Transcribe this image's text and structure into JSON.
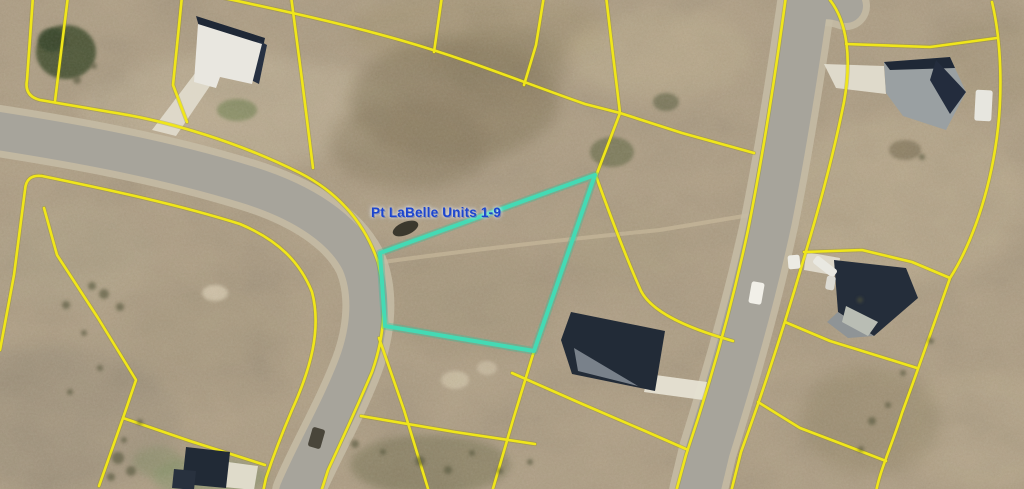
{
  "map": {
    "label": {
      "text": "Pt LaBelle Units 1-9",
      "x": 371,
      "y": 205,
      "font_size": 13.5,
      "color": "#1c45cf"
    },
    "canvas": {
      "width": 1024,
      "height": 489
    },
    "colors": {
      "terrain_base": "#b2a288",
      "road_pavement": "#a7a49b",
      "road_shoulder": "#c6bca6",
      "parcel_line_yellow": "#f0e61a",
      "parcel_line_under": "#8e8700",
      "highlight_cyan": "#44dab4",
      "highlight_glow": "#2fbf9a",
      "roof_navy": "#232c38",
      "roof_gray": "#9aa0a2",
      "driveway_white": "#e6e1d3",
      "track_pale": "#cbbd9e"
    },
    "terrain_patches": [
      {
        "cx": 240,
        "cy": 110,
        "rx": 160,
        "ry": 55,
        "fill": "#cbbda1",
        "op": 0.45,
        "f": "b8"
      },
      {
        "cx": 480,
        "cy": 30,
        "rx": 130,
        "ry": 40,
        "fill": "#a4946f",
        "op": 0.4,
        "f": "b8"
      },
      {
        "cx": 455,
        "cy": 100,
        "rx": 105,
        "ry": 62,
        "fill": "#837659",
        "op": 0.5,
        "f": "b8"
      },
      {
        "cx": 410,
        "cy": 145,
        "rx": 80,
        "ry": 45,
        "fill": "#8a7c5e",
        "op": 0.45,
        "f": "b8"
      },
      {
        "cx": 505,
        "cy": 65,
        "rx": 60,
        "ry": 40,
        "fill": "#8f8163",
        "op": 0.4,
        "f": "b8"
      },
      {
        "cx": 660,
        "cy": 55,
        "rx": 90,
        "ry": 45,
        "fill": "#c6b795",
        "op": 0.4,
        "f": "b8"
      },
      {
        "cx": 905,
        "cy": 200,
        "rx": 120,
        "ry": 85,
        "fill": "#c3b394",
        "op": 0.45,
        "f": "b8"
      },
      {
        "cx": 990,
        "cy": 60,
        "rx": 60,
        "ry": 45,
        "fill": "#ab9c7c",
        "op": 0.4,
        "f": "b8"
      },
      {
        "cx": 70,
        "cy": 255,
        "rx": 85,
        "ry": 55,
        "fill": "#b4a78c",
        "op": 0.4,
        "f": "b8"
      },
      {
        "cx": 60,
        "cy": 420,
        "rx": 120,
        "ry": 75,
        "fill": "#9c917b",
        "op": 0.45,
        "f": "b8"
      },
      {
        "cx": 210,
        "cy": 330,
        "rx": 90,
        "ry": 60,
        "fill": "#ab9d82",
        "op": 0.35,
        "f": "b8"
      },
      {
        "cx": 470,
        "cy": 300,
        "rx": 90,
        "ry": 55,
        "fill": "#a09274",
        "op": 0.3,
        "f": "b8"
      },
      {
        "cx": 620,
        "cy": 250,
        "rx": 70,
        "ry": 45,
        "fill": "#ad9f81",
        "op": 0.3,
        "f": "b8"
      },
      {
        "cx": 980,
        "cy": 430,
        "rx": 80,
        "ry": 60,
        "fill": "#c0b092",
        "op": 0.4,
        "f": "b8"
      },
      {
        "cx": 870,
        "cy": 420,
        "rx": 70,
        "ry": 55,
        "fill": "#948768",
        "op": 0.45,
        "f": "b8"
      },
      {
        "cx": 430,
        "cy": 465,
        "rx": 80,
        "ry": 30,
        "fill": "#6f6e4e",
        "op": 0.45,
        "f": "b4"
      },
      {
        "cx": 368,
        "cy": 295,
        "rx": 18,
        "ry": 50,
        "fill": "#cfc2a7",
        "op": 0.55,
        "f": "b4"
      },
      {
        "cx": 215,
        "cy": 293,
        "rx": 13,
        "ry": 8,
        "fill": "#dccfb4",
        "op": 0.8,
        "f": "b2"
      },
      {
        "cx": 455,
        "cy": 380,
        "rx": 14,
        "ry": 9,
        "fill": "#d3c6aa",
        "op": 0.75,
        "f": "b2"
      },
      {
        "cx": 487,
        "cy": 368,
        "rx": 10,
        "ry": 7,
        "fill": "#d0c3a8",
        "op": 0.7,
        "f": "b2"
      },
      {
        "cx": 66,
        "cy": 52,
        "rx": 30,
        "ry": 27,
        "fill": "#42502f",
        "op": 0.85,
        "f": "b2"
      },
      {
        "cx": 52,
        "cy": 40,
        "rx": 14,
        "ry": 12,
        "fill": "#39462a",
        "op": 0.8,
        "f": "b2"
      },
      {
        "cx": 237,
        "cy": 110,
        "rx": 20,
        "ry": 11,
        "fill": "#7e8a5c",
        "op": 0.7,
        "f": "b2"
      },
      {
        "cx": 612,
        "cy": 152,
        "rx": 22,
        "ry": 15,
        "fill": "#5d6540",
        "op": 0.55,
        "f": "b2"
      },
      {
        "cx": 666,
        "cy": 102,
        "rx": 13,
        "ry": 9,
        "fill": "#4f5637",
        "op": 0.5,
        "f": "b2"
      },
      {
        "cx": 905,
        "cy": 150,
        "rx": 16,
        "ry": 10,
        "fill": "#6c6247",
        "op": 0.5,
        "f": "b2"
      },
      {
        "cx": 210,
        "cy": 477,
        "rx": 58,
        "ry": 20,
        "fill": "#8c9a6f",
        "op": 0.55,
        "f": "b4"
      },
      {
        "cx": 158,
        "cy": 462,
        "rx": 25,
        "ry": 15,
        "fill": "#7f8f63",
        "op": 0.4,
        "f": "b4"
      }
    ],
    "shrub_dots": {
      "fill": "#55573c",
      "op": 0.6,
      "pts": [
        [
          66,
          305,
          4
        ],
        [
          84,
          333,
          3
        ],
        [
          104,
          294,
          5
        ],
        [
          92,
          286,
          4
        ],
        [
          120,
          307,
          4
        ],
        [
          100,
          368,
          3
        ],
        [
          70,
          392,
          3
        ],
        [
          140,
          422,
          3
        ],
        [
          118,
          458,
          6
        ],
        [
          131,
          471,
          5
        ],
        [
          111,
          477,
          4
        ],
        [
          124,
          440,
          3
        ],
        [
          355,
          444,
          4
        ],
        [
          383,
          452,
          3
        ],
        [
          420,
          461,
          5
        ],
        [
          448,
          470,
          4
        ],
        [
          472,
          453,
          3
        ],
        [
          500,
          471,
          3
        ],
        [
          530,
          462,
          3
        ],
        [
          872,
          421,
          4
        ],
        [
          888,
          405,
          3
        ],
        [
          903,
          373,
          3
        ],
        [
          861,
          449,
          3
        ],
        [
          931,
          341,
          3
        ],
        [
          922,
          157,
          3
        ],
        [
          860,
          300,
          3
        ],
        [
          77,
          80,
          4
        ],
        [
          94,
          66,
          3
        ]
      ]
    },
    "dirt_track": {
      "d": "M 383,262 C 470,250 580,238 660,230 L 756,214",
      "width": 4,
      "op": 0.6
    },
    "roads": [
      {
        "name": "west-road",
        "d": "M -8,130 C 70,142 160,158 245,184 C 305,202 344,230 360,262 C 373,292 370,330 357,365 C 340,410 315,452 298,492",
        "width": 38
      },
      {
        "name": "east-road",
        "d": "M 808,-10 C 798,60 786,140 770,220 C 753,300 730,380 708,450 L 698,492",
        "width": 44
      },
      {
        "name": "east-road-top-bend",
        "d": "M 806,6 C 818,2 830,0 846,6",
        "width": 34
      }
    ],
    "parcel_lines": [
      {
        "d": "M 33,-4 L 27,80 Q 24,96 40,100 L 110,112 C 170,121 240,143 300,173 C 345,196 367,230 378,262 C 387,300 385,335 372,372 C 360,400 342,440 328,470 L 321,492"
      },
      {
        "d": "M 68,-4 L 55,101"
      },
      {
        "d": "M 182,-4 L 173,85 L 187,122"
      },
      {
        "d": "M 291,-4 L 302,80 L 313,168"
      },
      {
        "d": "M 205,-6 C 260,6 330,20 400,40 C 470,60 530,85 585,104 L 620,113 L 682,133 L 754,153"
      },
      {
        "d": "M 606,-4 L 613,55 L 620,113"
      },
      {
        "d": "M 442,-4 L 434,52"
      },
      {
        "d": "M 544,-4 L 536,45 L 524,85"
      },
      {
        "d": "M 620,113 L 596,176 C 610,215 625,255 641,291 C 655,318 708,334 733,341"
      },
      {
        "d": "M 42,176 C 110,190 180,205 240,224 C 278,240 300,262 312,292 C 322,330 310,370 292,410 C 280,438 272,460 266,478 L 263,492"
      },
      {
        "d": "M 42,176 Q 26,174 25,190 L 14,275 L 0,350"
      },
      {
        "d": "M 44,208 L 57,255 L 98,318 L 136,380 L 123,418 L 99,486"
      },
      {
        "d": "M 123,418 L 190,441 L 265,465"
      },
      {
        "d": "M 379,338 L 404,410 L 429,492"
      },
      {
        "d": "M 534,351 L 513,420 L 492,492"
      },
      {
        "d": "M 512,373 L 580,403 L 645,431 L 686,449"
      },
      {
        "d": "M 361,416 L 455,432 L 535,444"
      },
      {
        "d": "M 830,0 C 847,22 852,58 844,102 C 834,152 820,205 804,258 C 786,320 763,392 741,452 L 731,492"
      },
      {
        "d": "M 786,-4 C 776,70 764,150 748,230 C 731,310 708,390 686,455 L 676,492"
      },
      {
        "d": "M 846,44 L 930,47 L 997,38"
      },
      {
        "d": "M 992,2 C 1001,40 1004,95 995,150 C 986,205 968,250 950,278 C 932,330 917,372 902,413 C 892,445 880,470 876,492"
      },
      {
        "d": "M 804,252 L 862,250 L 912,262 L 950,278"
      },
      {
        "d": "M 785,322 L 830,341 L 872,354 L 917,368"
      },
      {
        "d": "M 758,402 L 800,428 L 842,444 L 886,461"
      }
    ],
    "highlight_parcel": {
      "points": "595,175 380,253 385,326 534,351",
      "stroke_width": 4
    },
    "driveways": [
      {
        "points": "196,72 214,80 176,136 152,130",
        "fill": "#dfdacb"
      },
      {
        "points": "824,64 884,66 886,94 836,88",
        "fill": "#e2ddcf"
      },
      {
        "points": "806,252 840,258 838,276 804,270",
        "fill": "#e0dbcd"
      },
      {
        "points": "648,374 707,382 703,400 644,392",
        "fill": "#e6e1d3"
      },
      {
        "points": "228,462 258,466 254,490 224,487",
        "fill": "#e3decf"
      }
    ],
    "houses": [
      {
        "name": "house-northwest",
        "parts": [
          {
            "points": "196,16 265,38 262,52 200,30",
            "fill": "#1f2836"
          },
          {
            "points": "258,40 267,45 259,84 251,80",
            "fill": "#273142"
          },
          {
            "points": "198,24 262,44 252,84 220,77 216,88 194,82",
            "fill": "#e9e7e0"
          }
        ]
      },
      {
        "name": "house-northeast",
        "parts": [
          {
            "points": "884,62 950,57 966,92 946,130 903,116 886,93",
            "fill": "#9aa0a2"
          },
          {
            "points": "884,62 950,57 955,68 890,70",
            "fill": "#1f2836"
          },
          {
            "points": "936,60 966,92 950,114 930,80",
            "fill": "#232c3d"
          }
        ]
      },
      {
        "name": "house-east-middle",
        "parts": [
          {
            "points": "834,260 906,268 918,298 874,336 838,312",
            "fill": "#242d3a"
          },
          {
            "points": "838,312 874,336 848,338 827,322",
            "fill": "#8f9496"
          },
          {
            "points": "846,306 878,322 868,336 842,322",
            "fill": "#b9bdb4"
          }
        ]
      },
      {
        "name": "house-south-center",
        "parts": [
          {
            "points": "571,312 665,331 655,391 572,374 561,340",
            "fill": "#222b37"
          },
          {
            "points": "574,348 638,386 578,371",
            "fill": "#79818a"
          }
        ]
      },
      {
        "name": "house-southwest",
        "parts": [
          {
            "points": "186,447 230,452 226,488 182,484",
            "fill": "#212a36"
          },
          {
            "points": "174,469 196,471 194,490 172,488",
            "fill": "#28313e"
          }
        ]
      }
    ],
    "vehicles": [
      {
        "x": 750,
        "y": 282,
        "w": 13,
        "h": 22,
        "rot": 10,
        "fill": "#f1efe8"
      },
      {
        "x": 788,
        "y": 255,
        "w": 12,
        "h": 14,
        "rot": -5,
        "fill": "#ecebe4"
      },
      {
        "x": 812,
        "y": 262,
        "w": 26,
        "h": 9,
        "rot": 38,
        "fill": "#e9e8e1"
      },
      {
        "x": 826,
        "y": 276,
        "w": 9,
        "h": 14,
        "rot": 10,
        "fill": "#dcdad2"
      },
      {
        "x": 975,
        "y": 90,
        "w": 17,
        "h": 31,
        "rot": 3,
        "fill": "#e7e6df"
      },
      {
        "x": 310,
        "y": 428,
        "w": 13,
        "h": 20,
        "rot": 16,
        "fill": "#49453a"
      },
      {
        "x": 392,
        "y": 222,
        "w": 27,
        "h": 13,
        "rot": -22,
        "fill": "#3b382d",
        "ellipse": true
      }
    ]
  }
}
